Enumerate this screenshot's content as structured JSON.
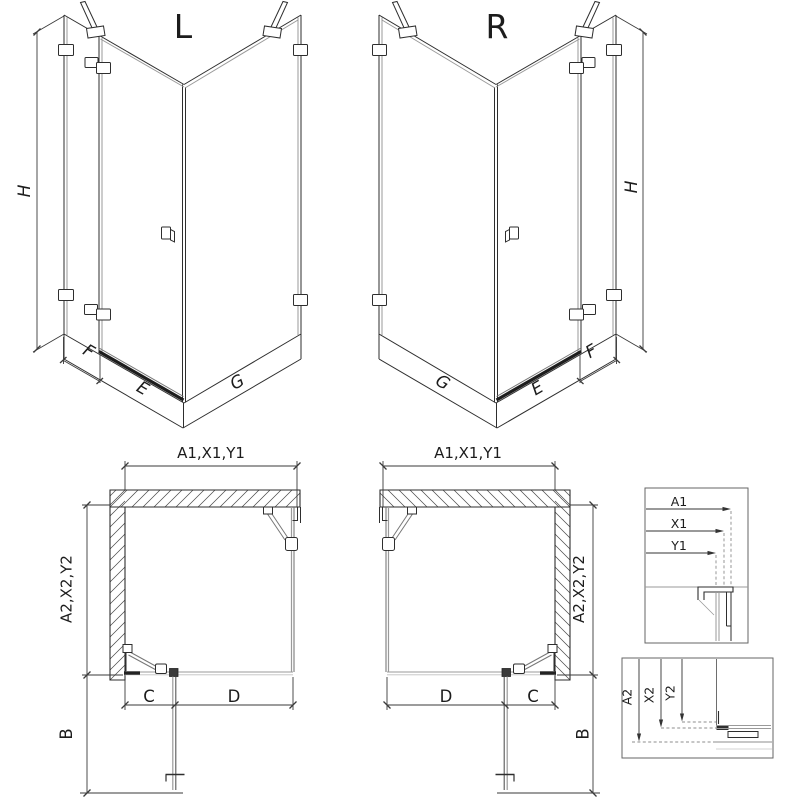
{
  "views": {
    "iso_left": {
      "label": "L",
      "height": "H",
      "fixed_width": "F",
      "door_width": "E",
      "side_width": "G"
    },
    "iso_right": {
      "label": "R",
      "height": "H",
      "fixed_width": "F",
      "door_width": "E",
      "side_width": "G"
    },
    "plan_left": {
      "width_dim": "A1,X1,Y1",
      "depth_dim": "A2,X2,Y2",
      "segment_c": "C",
      "segment_d": "D",
      "door_projection": "B"
    },
    "plan_right": {
      "width_dim": "A1,X1,Y1",
      "depth_dim": "A2,X2,Y2",
      "segment_c": "C",
      "segment_d": "D",
      "door_projection": "B"
    },
    "width_detail": {
      "a1": "A1",
      "x1": "X1",
      "y1": "Y1"
    },
    "depth_detail": {
      "a2": "A2",
      "x2": "X2",
      "y2": "Y2"
    }
  },
  "colors": {
    "line": "#2e2e2e",
    "glass": "#9a9a9a",
    "dim": "#3a3a3a",
    "dark": "#1d1d1d"
  }
}
